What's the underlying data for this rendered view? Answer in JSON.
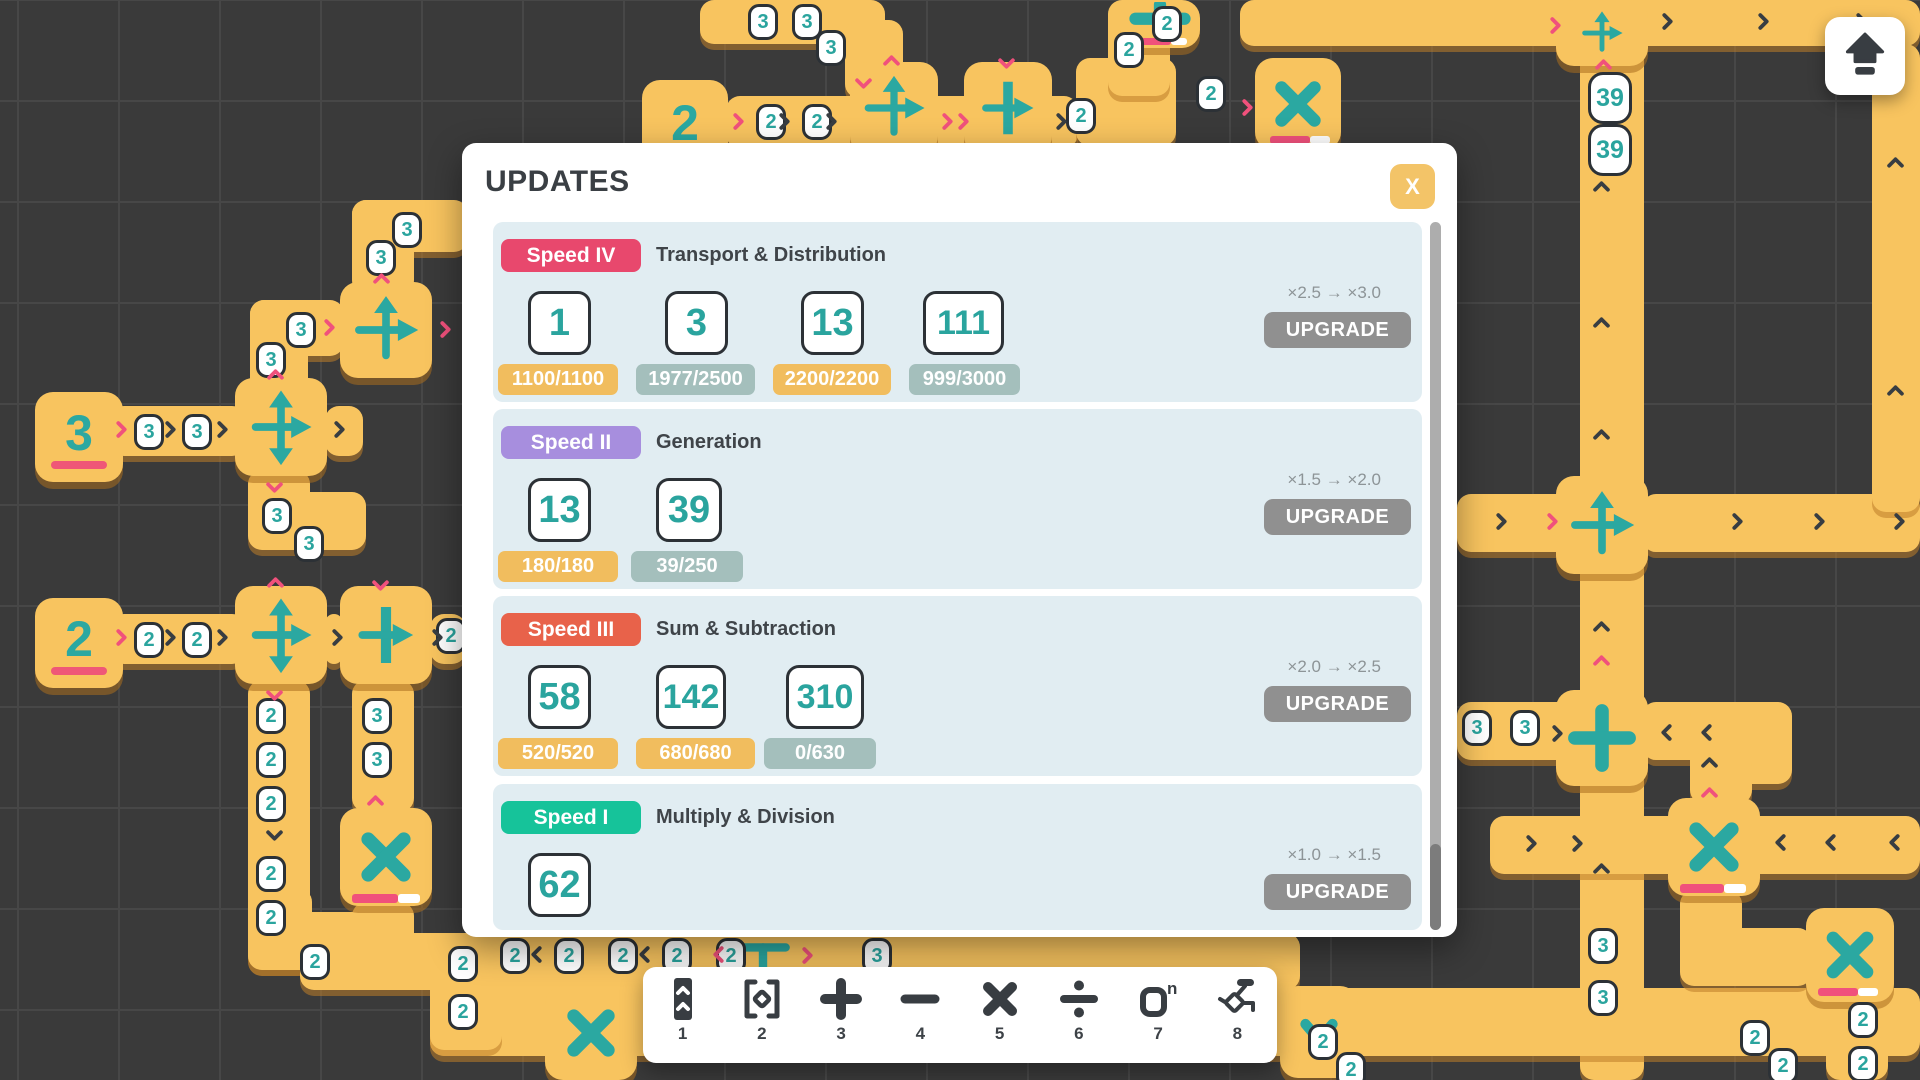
{
  "modal": {
    "title": "UPDATES",
    "close_label": "X",
    "sections": [
      {
        "badge": "Speed IV",
        "badge_color": "#e8486d",
        "category": "Transport & Distribution",
        "cards": [
          {
            "value": "1",
            "x": 35,
            "w": 63
          },
          {
            "value": "3",
            "x": 172,
            "w": 63
          },
          {
            "value": "13",
            "x": 308,
            "w": 63
          },
          {
            "value": "111",
            "x": 430,
            "w": 81
          }
        ],
        "chips": [
          {
            "text": "1100/1100",
            "x": 5,
            "w": 120,
            "state": "full"
          },
          {
            "text": "1977/2500",
            "x": 143,
            "w": 119,
            "state": "part"
          },
          {
            "text": "2200/2200",
            "x": 280,
            "w": 118,
            "state": "full"
          },
          {
            "text": "999/3000",
            "x": 416,
            "w": 111,
            "state": "part"
          }
        ],
        "upgrade_label": "×2.5 → ×3.0",
        "button_label": "UPGRADE",
        "top": 79,
        "height": 180
      },
      {
        "badge": "Speed II",
        "badge_color": "#a78ede",
        "category": "Generation",
        "cards": [
          {
            "value": "13",
            "x": 35,
            "w": 63
          },
          {
            "value": "39",
            "x": 163,
            "w": 66
          }
        ],
        "chips": [
          {
            "text": "180/180",
            "x": 5,
            "w": 120,
            "state": "full"
          },
          {
            "text": "39/250",
            "x": 138,
            "w": 112,
            "state": "part"
          }
        ],
        "upgrade_label": "×1.5 → ×2.0",
        "button_label": "UPGRADE",
        "top": 266,
        "height": 180
      },
      {
        "badge": "Speed III",
        "badge_color": "#e8624a",
        "category": "Sum & Subtraction",
        "cards": [
          {
            "value": "58",
            "x": 35,
            "w": 63
          },
          {
            "value": "142",
            "x": 163,
            "w": 70
          },
          {
            "value": "310",
            "x": 293,
            "w": 78
          }
        ],
        "chips": [
          {
            "text": "520/520",
            "x": 5,
            "w": 120,
            "state": "full"
          },
          {
            "text": "680/680",
            "x": 143,
            "w": 119,
            "state": "full"
          },
          {
            "text": "0/630",
            "x": 271,
            "w": 112,
            "state": "part"
          }
        ],
        "upgrade_label": "×2.0 → ×2.5",
        "button_label": "UPGRADE",
        "top": 453,
        "height": 180
      },
      {
        "badge": "Speed I",
        "badge_color": "#16c39a",
        "category": "Multiply & Division",
        "cards": [
          {
            "value": "62",
            "x": 35,
            "w": 63
          }
        ],
        "chips": [],
        "upgrade_label": "×1.0 → ×1.5",
        "button_label": "UPGRADE",
        "top": 641,
        "height": 146
      }
    ]
  },
  "toolbar": {
    "items": [
      {
        "num": "1",
        "icon": "belt-icon"
      },
      {
        "num": "2",
        "icon": "extractor-icon"
      },
      {
        "num": "3",
        "icon": "plus-icon"
      },
      {
        "num": "4",
        "icon": "minus-icon"
      },
      {
        "num": "5",
        "icon": "multiply-icon"
      },
      {
        "num": "6",
        "icon": "divide-icon"
      },
      {
        "num": "7",
        "icon": "exponent-icon"
      },
      {
        "num": "8",
        "icon": "splitter-icon"
      }
    ]
  },
  "top_button": {
    "icon": "upgrade-arrow-icon"
  },
  "colors": {
    "chip_full": "#f1bd5e",
    "chip_part": "#a4bfbc",
    "teal": "#2ba8a1",
    "belt": "#f8c45f",
    "pink": "#f0517c",
    "dark": "#383d42"
  },
  "background": {
    "generators": [
      {
        "x": 35,
        "y": 392,
        "w": 88,
        "h": 90,
        "value": "3"
      },
      {
        "x": 35,
        "y": 598,
        "w": 88,
        "h": 90,
        "value": "2"
      },
      {
        "x": 642,
        "y": 80,
        "w": 86,
        "h": 94,
        "value": "2"
      }
    ],
    "belts": [
      [
        1580,
        0,
        64,
        1080
      ],
      [
        1240,
        0,
        680,
        46
      ],
      [
        700,
        0,
        185,
        44
      ],
      [
        845,
        20,
        58,
        78
      ],
      [
        726,
        96,
        352,
        52
      ],
      [
        1076,
        58,
        100,
        88
      ],
      [
        1108,
        0,
        62,
        96
      ],
      [
        352,
        200,
        116,
        52
      ],
      [
        352,
        200,
        62,
        94
      ],
      [
        250,
        300,
        94,
        56
      ],
      [
        250,
        300,
        58,
        114
      ],
      [
        110,
        406,
        136,
        50
      ],
      [
        325,
        406,
        38,
        50
      ],
      [
        248,
        470,
        62,
        60
      ],
      [
        248,
        492,
        118,
        58
      ],
      [
        110,
        614,
        136,
        50
      ],
      [
        325,
        614,
        18,
        50
      ],
      [
        430,
        614,
        36,
        50
      ],
      [
        248,
        680,
        62,
        234
      ],
      [
        352,
        680,
        62,
        132
      ],
      [
        352,
        902,
        62,
        64
      ],
      [
        248,
        888,
        64,
        82
      ],
      [
        248,
        912,
        128,
        58
      ],
      [
        300,
        933,
        1000,
        57
      ],
      [
        430,
        988,
        1490,
        68
      ],
      [
        430,
        958,
        72,
        92
      ],
      [
        1457,
        494,
        125,
        58
      ],
      [
        1642,
        494,
        278,
        58
      ],
      [
        1872,
        44,
        48,
        468
      ],
      [
        1457,
        702,
        125,
        58
      ],
      [
        1642,
        702,
        112,
        58
      ],
      [
        1690,
        702,
        102,
        82
      ],
      [
        1690,
        752,
        62,
        52
      ],
      [
        1490,
        816,
        430,
        58
      ],
      [
        1680,
        890,
        62,
        68
      ],
      [
        1680,
        928,
        132,
        58
      ],
      [
        1826,
        998,
        62,
        82
      ]
    ],
    "tiles": [
      {
        "x": 235,
        "y": 378,
        "w": 92,
        "h": 98,
        "type": "cross4"
      },
      {
        "x": 340,
        "y": 282,
        "w": 92,
        "h": 96,
        "type": "upright"
      },
      {
        "x": 235,
        "y": 586,
        "w": 92,
        "h": 98,
        "type": "cross4"
      },
      {
        "x": 340,
        "y": 586,
        "w": 92,
        "h": 98,
        "type": "barright"
      },
      {
        "x": 340,
        "y": 808,
        "w": 92,
        "h": 98,
        "type": "mult"
      },
      {
        "x": 850,
        "y": 62,
        "w": 88,
        "h": 92,
        "type": "upright"
      },
      {
        "x": 964,
        "y": 62,
        "w": 88,
        "h": 92,
        "type": "barright"
      },
      {
        "x": 1255,
        "y": 58,
        "w": 86,
        "h": 92,
        "type": "mult"
      },
      {
        "x": 1120,
        "y": 0,
        "w": 80,
        "h": 48,
        "type": "plusflat"
      },
      {
        "x": 1556,
        "y": 0,
        "w": 92,
        "h": 66,
        "type": "upright"
      },
      {
        "x": 1556,
        "y": 476,
        "w": 92,
        "h": 98,
        "type": "upright"
      },
      {
        "x": 1556,
        "y": 690,
        "w": 92,
        "h": 96,
        "type": "plus"
      },
      {
        "x": 1668,
        "y": 798,
        "w": 92,
        "h": 98,
        "type": "mult"
      },
      {
        "x": 1806,
        "y": 908,
        "w": 88,
        "h": 94,
        "type": "mult"
      },
      {
        "x": 545,
        "y": 986,
        "w": 92,
        "h": 94,
        "type": "mult"
      },
      {
        "x": 1280,
        "y": 986,
        "w": 78,
        "h": 92,
        "type": "darr"
      },
      {
        "x": 722,
        "y": 929,
        "w": 82,
        "h": 62,
        "type": "tbar"
      }
    ],
    "bars": [
      [
        352,
        894,
        46,
        9,
        "pink"
      ],
      [
        398,
        894,
        22,
        9,
        "white"
      ],
      [
        1270,
        136,
        40,
        8,
        "pink"
      ],
      [
        1310,
        136,
        20,
        8,
        "white"
      ],
      [
        1133,
        38,
        38,
        7,
        "pink"
      ],
      [
        1171,
        38,
        16,
        7,
        "white"
      ],
      [
        1680,
        884,
        44,
        9,
        "pink"
      ],
      [
        1724,
        884,
        22,
        9,
        "white"
      ],
      [
        1818,
        988,
        40,
        8,
        "pink"
      ],
      [
        1858,
        988,
        20,
        8,
        "white"
      ]
    ],
    "badges": [
      {
        "x": 392,
        "y": 212,
        "n": "3"
      },
      {
        "x": 366,
        "y": 240,
        "n": "3"
      },
      {
        "x": 286,
        "y": 312,
        "n": "3"
      },
      {
        "x": 256,
        "y": 342,
        "n": "3"
      },
      {
        "x": 262,
        "y": 498,
        "n": "3"
      },
      {
        "x": 294,
        "y": 526,
        "n": "3"
      },
      {
        "x": 134,
        "y": 414,
        "n": "3"
      },
      {
        "x": 182,
        "y": 414,
        "n": "3"
      },
      {
        "x": 134,
        "y": 622,
        "n": "2"
      },
      {
        "x": 182,
        "y": 622,
        "n": "2"
      },
      {
        "x": 436,
        "y": 618,
        "n": "2"
      },
      {
        "x": 256,
        "y": 698,
        "n": "2"
      },
      {
        "x": 256,
        "y": 742,
        "n": "2"
      },
      {
        "x": 256,
        "y": 786,
        "n": "2"
      },
      {
        "x": 362,
        "y": 698,
        "n": "3"
      },
      {
        "x": 362,
        "y": 742,
        "n": "3"
      },
      {
        "x": 256,
        "y": 856,
        "n": "2"
      },
      {
        "x": 256,
        "y": 900,
        "n": "2"
      },
      {
        "x": 300,
        "y": 944,
        "n": "2"
      },
      {
        "x": 448,
        "y": 946,
        "n": "2"
      },
      {
        "x": 448,
        "y": 994,
        "n": "2"
      },
      {
        "x": 500,
        "y": 938,
        "n": "2"
      },
      {
        "x": 554,
        "y": 938,
        "n": "2"
      },
      {
        "x": 608,
        "y": 938,
        "n": "2"
      },
      {
        "x": 662,
        "y": 938,
        "n": "2"
      },
      {
        "x": 716,
        "y": 938,
        "n": "2"
      },
      {
        "x": 862,
        "y": 938,
        "n": "3"
      },
      {
        "x": 1308,
        "y": 1024,
        "n": "2"
      },
      {
        "x": 1336,
        "y": 1052,
        "n": "2"
      },
      {
        "x": 756,
        "y": 104,
        "n": "2"
      },
      {
        "x": 802,
        "y": 104,
        "n": "2"
      },
      {
        "x": 1066,
        "y": 98,
        "n": "2"
      },
      {
        "x": 1114,
        "y": 32,
        "n": "2"
      },
      {
        "x": 1152,
        "y": 6,
        "n": "2"
      },
      {
        "x": 748,
        "y": 4,
        "n": "3"
      },
      {
        "x": 792,
        "y": 4,
        "n": "3"
      },
      {
        "x": 816,
        "y": 30,
        "n": "3"
      },
      {
        "x": 1196,
        "y": 76,
        "n": "2"
      },
      {
        "x": 1588,
        "y": 72,
        "n": "39",
        "big": true
      },
      {
        "x": 1588,
        "y": 124,
        "n": "39",
        "big": true
      },
      {
        "x": 1462,
        "y": 710,
        "n": "3"
      },
      {
        "x": 1510,
        "y": 710,
        "n": "3"
      },
      {
        "x": 1588,
        "y": 928,
        "n": "3"
      },
      {
        "x": 1588,
        "y": 980,
        "n": "3"
      },
      {
        "x": 1740,
        "y": 1020,
        "n": "2"
      },
      {
        "x": 1768,
        "y": 1048,
        "n": "2"
      },
      {
        "x": 1848,
        "y": 1002,
        "n": "2"
      },
      {
        "x": 1848,
        "y": 1046,
        "n": "2"
      }
    ],
    "chevrons": [
      [
        114,
        420,
        "r",
        "p"
      ],
      [
        163,
        420,
        "r",
        "d"
      ],
      [
        215,
        420,
        "r",
        "d"
      ],
      [
        268,
        366,
        "u",
        "p"
      ],
      [
        268,
        478,
        "d",
        "p"
      ],
      [
        332,
        420,
        "r",
        "d"
      ],
      [
        374,
        270,
        "u",
        "p"
      ],
      [
        438,
        320,
        "r",
        "p"
      ],
      [
        322,
        318,
        "r",
        "p"
      ],
      [
        114,
        628,
        "r",
        "p"
      ],
      [
        163,
        628,
        "r",
        "d"
      ],
      [
        215,
        628,
        "r",
        "d"
      ],
      [
        268,
        574,
        "u",
        "p"
      ],
      [
        268,
        686,
        "d",
        "p"
      ],
      [
        374,
        576,
        "d",
        "p"
      ],
      [
        330,
        628,
        "r",
        "d"
      ],
      [
        430,
        628,
        "r",
        "d"
      ],
      [
        268,
        826,
        "d",
        "d"
      ],
      [
        368,
        792,
        "u",
        "p"
      ],
      [
        530,
        946,
        "l",
        "d"
      ],
      [
        638,
        946,
        "l",
        "d"
      ],
      [
        712,
        946,
        "l",
        "p"
      ],
      [
        800,
        946,
        "r",
        "p"
      ],
      [
        1660,
        12,
        "r",
        "d"
      ],
      [
        1756,
        12,
        "r",
        "d"
      ],
      [
        1854,
        12,
        "r",
        "d"
      ],
      [
        1548,
        16,
        "r",
        "p"
      ],
      [
        731,
        112,
        "r",
        "p"
      ],
      [
        777,
        112,
        "r",
        "d"
      ],
      [
        824,
        112,
        "r",
        "d"
      ],
      [
        884,
        52,
        "u",
        "p"
      ],
      [
        940,
        112,
        "r",
        "p"
      ],
      [
        956,
        112,
        "r",
        "p"
      ],
      [
        1000,
        54,
        "d",
        "p"
      ],
      [
        1054,
        112,
        "r",
        "d"
      ],
      [
        1240,
        98,
        "r",
        "p"
      ],
      [
        857,
        74,
        "d",
        "p"
      ],
      [
        1596,
        56,
        "u",
        "p"
      ],
      [
        1594,
        178,
        "u",
        "d"
      ],
      [
        1594,
        314,
        "u",
        "d"
      ],
      [
        1594,
        426,
        "u",
        "d"
      ],
      [
        1545,
        512,
        "r",
        "p"
      ],
      [
        1494,
        512,
        "r",
        "d"
      ],
      [
        1730,
        512,
        "r",
        "d"
      ],
      [
        1812,
        512,
        "r",
        "d"
      ],
      [
        1892,
        512,
        "r",
        "d"
      ],
      [
        1888,
        154,
        "u",
        "d"
      ],
      [
        1888,
        382,
        "u",
        "d"
      ],
      [
        1594,
        618,
        "u",
        "d"
      ],
      [
        1594,
        652,
        "u",
        "p"
      ],
      [
        1550,
        724,
        "r",
        "d"
      ],
      [
        1660,
        724,
        "l",
        "d"
      ],
      [
        1700,
        724,
        "l",
        "d"
      ],
      [
        1702,
        754,
        "u",
        "d"
      ],
      [
        1702,
        784,
        "u",
        "p"
      ],
      [
        1524,
        834,
        "r",
        "d"
      ],
      [
        1570,
        834,
        "r",
        "d"
      ],
      [
        1774,
        834,
        "l",
        "d"
      ],
      [
        1824,
        834,
        "l",
        "d"
      ],
      [
        1888,
        834,
        "l",
        "d"
      ],
      [
        1594,
        860,
        "u",
        "d"
      ]
    ]
  }
}
